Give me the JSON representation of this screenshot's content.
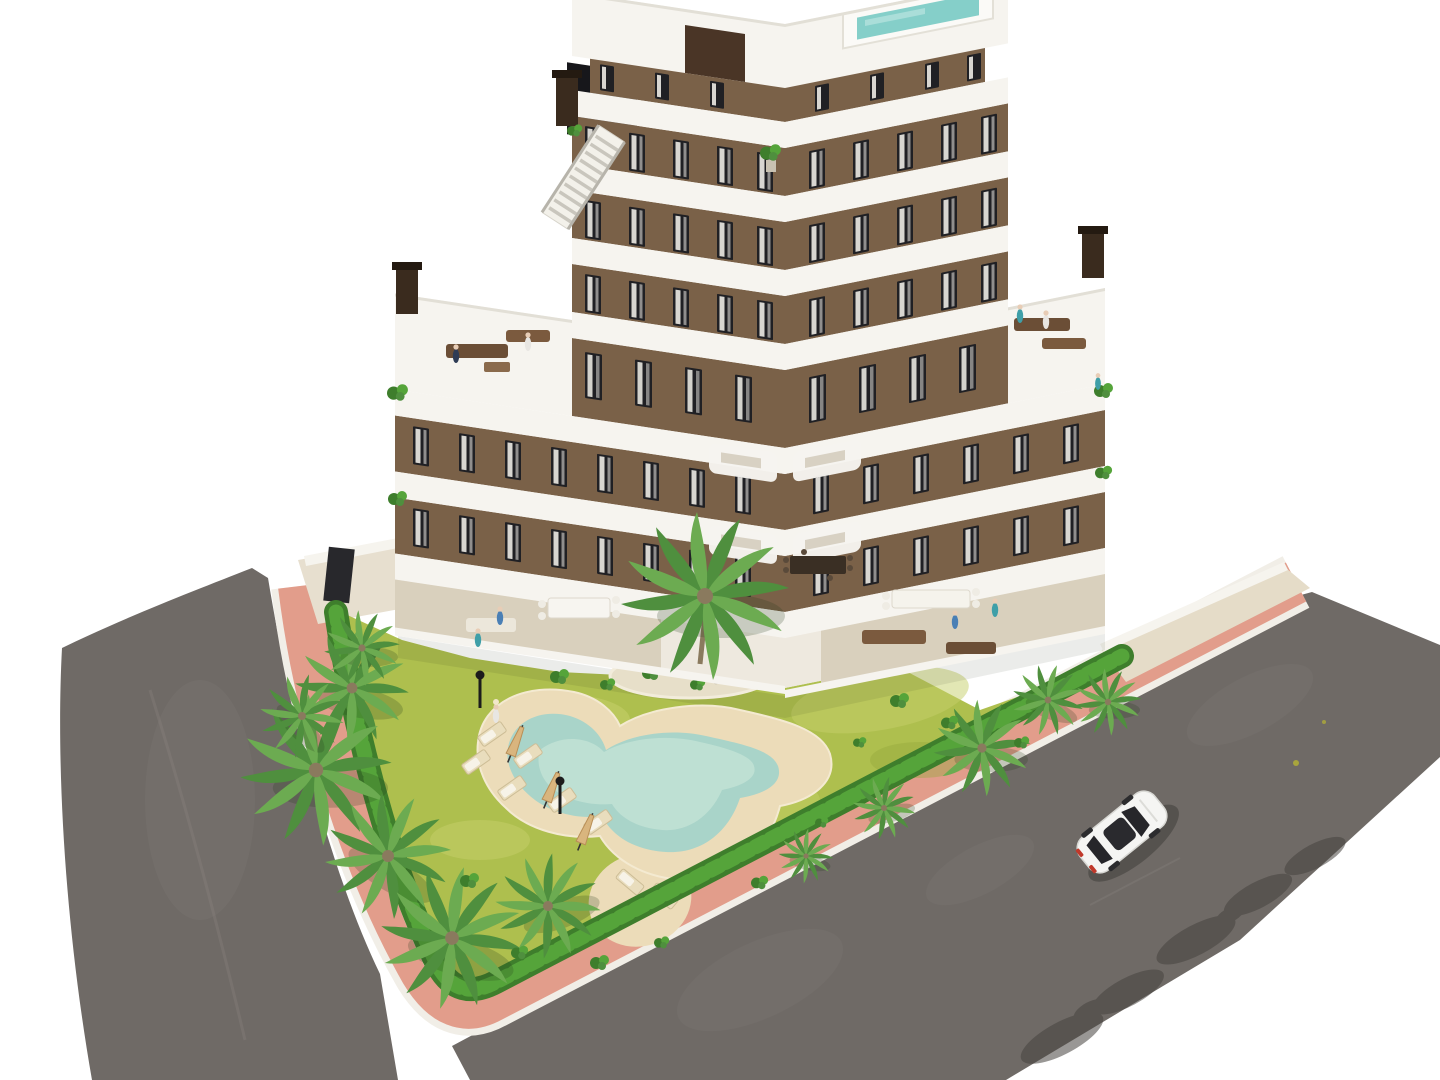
{
  "image": {
    "kind": "architectural-3d-render",
    "description": "Aerial cut-out render of a modern 7-storey apartment building with brown facades and white curved balcony bands, two roof-terrace wings with chimneys, rooftop deck with staircase and plunge pool, front garden with freeform pool, sun loungers, parasols, palm trees and perimeter hedge, pink sidewalk ring, two asphalt roads and a single white car.",
    "visible_text": "none",
    "width_px": 1440,
    "height_px": 1080
  },
  "palette": {
    "background": "#ffffff",
    "facade_brown": "#7a6148",
    "facade_dark": "#4a3526",
    "band_white": "#f6f4ef",
    "window_dark": "#202024",
    "curtain_white": "#eceae4",
    "roof_deck_white": "#f3f1ea",
    "terrace_beige": "#d9d0bd",
    "courtyard_white": "#eee9df",
    "wood_brown": "#7b5a3e",
    "wood_dark": "#6b4e36",
    "pool_water": "#a9d4c9",
    "pool_water_light": "#c3e2d6",
    "rooftop_pool": "#85cfc9",
    "sand": "#ecdcb9",
    "island_sand": "#e7dfc9",
    "lawn": "#aebf4e",
    "lawn_light": "#c6d069",
    "lawn_dark": "#93a73d",
    "hedge": "#55a43a",
    "hedge_dark": "#3e7e2c",
    "palm_green": "#4f8f3e",
    "palm_green_light": "#6cab51",
    "trunk_brown": "#8a7a5e",
    "sidewalk_pink": "#e29d8b",
    "curb_white": "#f1eee7",
    "road_gray": "#6f6a66",
    "road_light": "#7d7874",
    "shadow_dark": "#46433f",
    "car_white": "#f5f5f3",
    "car_glass": "#26262a",
    "taillight_red": "#c0392b",
    "parasol_tan": "#d9b57e",
    "lamp_black": "#1c1c1c",
    "people_teal": "#3f9fa8",
    "people_blue": "#4a7fb5",
    "people_navy": "#2e3b55",
    "people_white": "#e8e6e2"
  },
  "scene": {
    "building": {
      "storeys_visible": 7,
      "balcony_bands": 7,
      "roof_terrace_wings": 2,
      "chimneys": 3,
      "rooftop": {
        "deck": true,
        "staircase": true,
        "plunge_pool": true,
        "potted_plants": true
      }
    },
    "garden": {
      "lawn": true,
      "perimeter_hedge": true,
      "planting_island": true,
      "palm_trees": 12,
      "swimming_pool_shape": "freeform-boomerang",
      "sun_loungers": 8,
      "closed_parasols": 3,
      "lamp_posts": 2
    },
    "streets": {
      "roads": 2,
      "sidewalk_ring": true,
      "white_car": 1,
      "palm_shadows_on_road": true
    },
    "people_count_approx": 14
  }
}
